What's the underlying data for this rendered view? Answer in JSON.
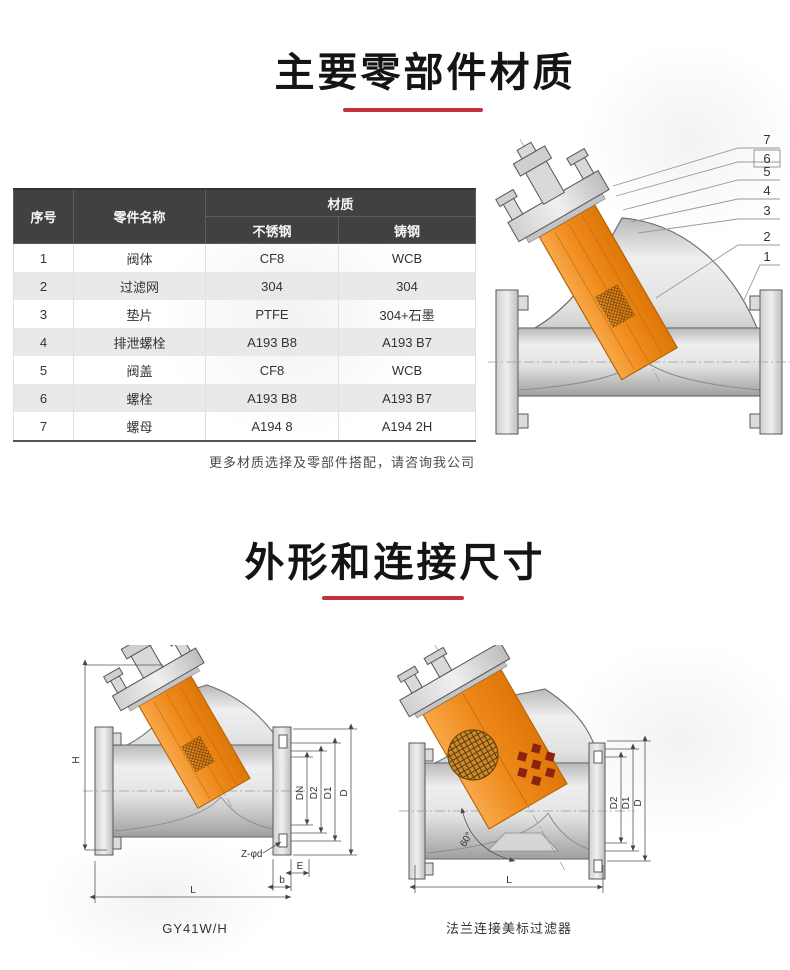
{
  "section_materials": {
    "title": "主要零部件材质"
  },
  "materials_table": {
    "headers": {
      "col_no": "序号",
      "col_part": "零件名称",
      "col_material": "材质",
      "sub_stainless": "不锈钢",
      "sub_cast": "铸钢"
    },
    "rows": [
      {
        "no": "1",
        "part": "阀体",
        "stainless": "CF8",
        "cast": "WCB"
      },
      {
        "no": "2",
        "part": "过滤网",
        "stainless": "304",
        "cast": "304"
      },
      {
        "no": "3",
        "part": "垫片",
        "stainless": "PTFE",
        "cast": "304+石墨"
      },
      {
        "no": "4",
        "part": "排泄螺栓",
        "stainless": "A193 B8",
        "cast": "A193 B7"
      },
      {
        "no": "5",
        "part": "阀盖",
        "stainless": "CF8",
        "cast": "WCB"
      },
      {
        "no": "6",
        "part": "螺栓",
        "stainless": "A193 B8",
        "cast": "A193 B7"
      },
      {
        "no": "7",
        "part": "螺母",
        "stainless": "A194 8",
        "cast": "A194 2H"
      }
    ],
    "note": "更多材质选择及零部件搭配，请咨询我公司"
  },
  "parts_diagram": {
    "callouts": [
      "7",
      "6",
      "5",
      "4",
      "3",
      "2",
      "1"
    ]
  },
  "section_dimensions": {
    "title": "外形和连接尺寸"
  },
  "drawing_left": {
    "caption": "GY41W/H",
    "dims": {
      "h": "H",
      "dn": "DN",
      "d2": "D2",
      "d1": "D1",
      "d": "D",
      "zd": "Z-φd",
      "e": "E",
      "b": "b",
      "l": "L"
    }
  },
  "drawing_right": {
    "caption": "法兰连接美标过滤器",
    "dims": {
      "angle": "60°",
      "d2": "D2",
      "d1": "D1",
      "d": "D",
      "l": "L"
    }
  },
  "colors": {
    "accent_red": "#c4323e",
    "strainer_orange": "#ef8a1c",
    "table_header_bg": "#414144"
  }
}
